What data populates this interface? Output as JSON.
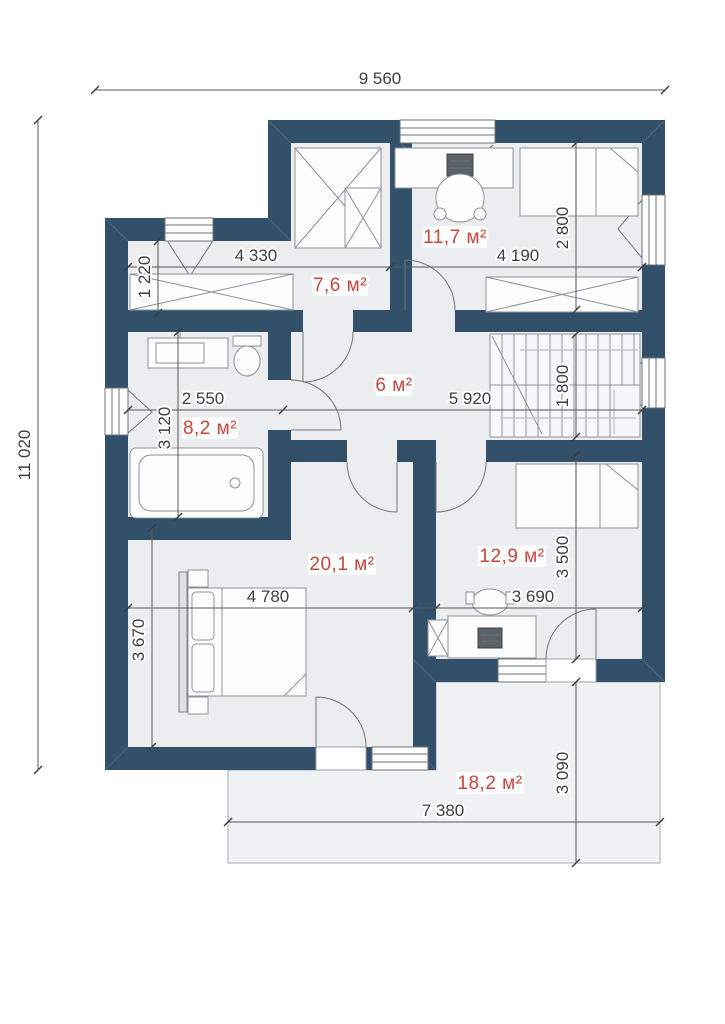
{
  "plan": {
    "type": "architectural-floor-plan",
    "colors": {
      "wall": "#32506a",
      "floor": "#ecedef",
      "terrace": "#f0f1f3",
      "area_label": "#c7463d",
      "dimension_text": "#3d3f41"
    },
    "overall_dimensions": {
      "width": "9 560",
      "height": "11 020"
    },
    "rooms": [
      {
        "id": "top-bedroom",
        "area": "11,7 м²",
        "width": "4 190",
        "height": "2 800"
      },
      {
        "id": "wardrobe",
        "area": "7,6 м²",
        "width": "4 330",
        "depth": "1 220"
      },
      {
        "id": "hallway",
        "area": "6 м²",
        "width": "5 920"
      },
      {
        "id": "staircase",
        "height": "1 800"
      },
      {
        "id": "bathroom",
        "area": "8,2 м²",
        "width": "2 550",
        "height": "3 120"
      },
      {
        "id": "bedroom-left",
        "area": "20,1 м²",
        "width": "4 780",
        "height": "3 670"
      },
      {
        "id": "bedroom-right",
        "area": "12,9 м²",
        "width": "3 690",
        "height": "3 500"
      },
      {
        "id": "terrace",
        "area": "18,2 м²",
        "width": "7 380",
        "height": "3 090"
      }
    ]
  }
}
